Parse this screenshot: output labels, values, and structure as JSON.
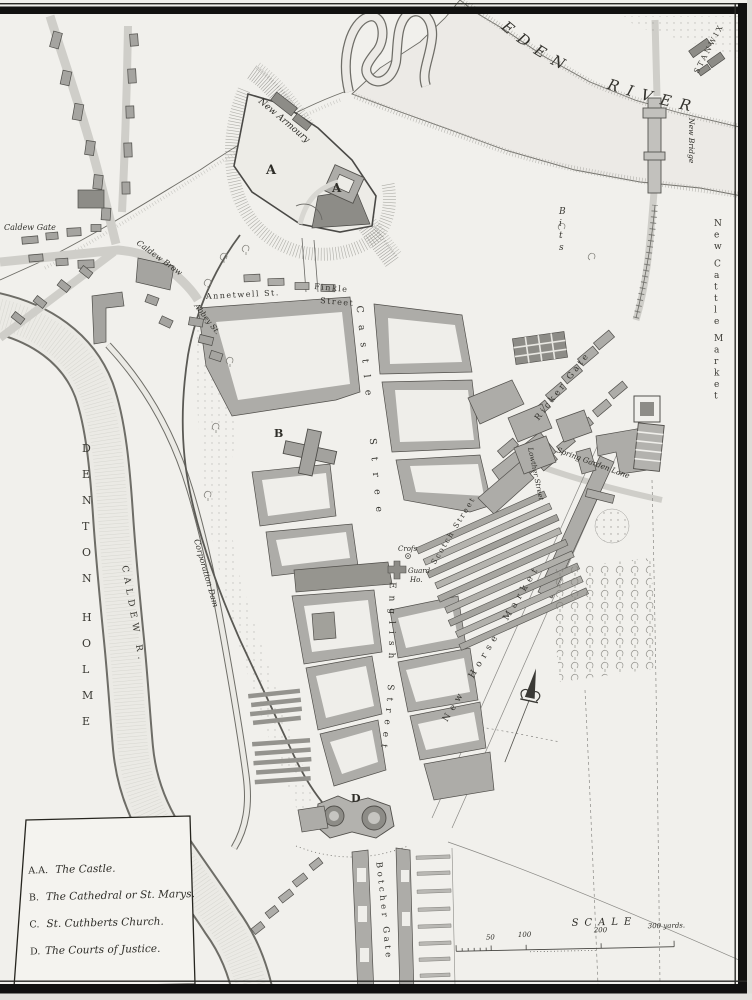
{
  "map": {
    "title": "Plan of the City of Carlisle",
    "region_labels": {
      "eden_river": "EDEN RIVER",
      "stanwix": "STANWIX",
      "bits": "Bits",
      "denton_holme": "DENTON HOLME",
      "caldew_river": "CALDEW R.",
      "new_cattle_market": "New Cattle Market"
    },
    "street_labels": {
      "annetwell": "Annetwell St.",
      "finkle_1": "Finkle",
      "finkle_2": "Street",
      "castle": "Castle Street",
      "english": "English Street",
      "scotch": "Scotch Street",
      "botcher_gate": "Botcher Gate",
      "ricker_gate": "Ricker Gate",
      "new_horse_market": "New Horse Market",
      "lowther": "Lowther Street",
      "spring_garden": "Spring Garden Lane",
      "abbey": "Abbey St.",
      "caldew_brow": "Caldew Brow",
      "caldew_gate": "Caldew Gate",
      "new_bridge": "New Bridge",
      "corporation_dam": "Corporation Dam"
    },
    "place_labels": {
      "new_armoury": "New Armoury",
      "cross": "Crofs",
      "guard_house_1": "Guard",
      "guard_house_2": "Ho."
    },
    "markers": {
      "castle_a_1": "A",
      "castle_a_2": "A",
      "cathedral_b": "B",
      "courts_d": "D"
    },
    "legend": {
      "items": [
        {
          "key": "A.A.",
          "label": "The Castle."
        },
        {
          "key": "B.",
          "label": "The Cathedral or St. Marys."
        },
        {
          "key": "C.",
          "label": "St. Cuthberts Church."
        },
        {
          "key": "D.",
          "label": "The Courts of Justice."
        }
      ]
    },
    "scale_bar": {
      "title": "SCALE",
      "tick_labels": [
        "50",
        "100",
        "200",
        "300 yards."
      ]
    }
  }
}
